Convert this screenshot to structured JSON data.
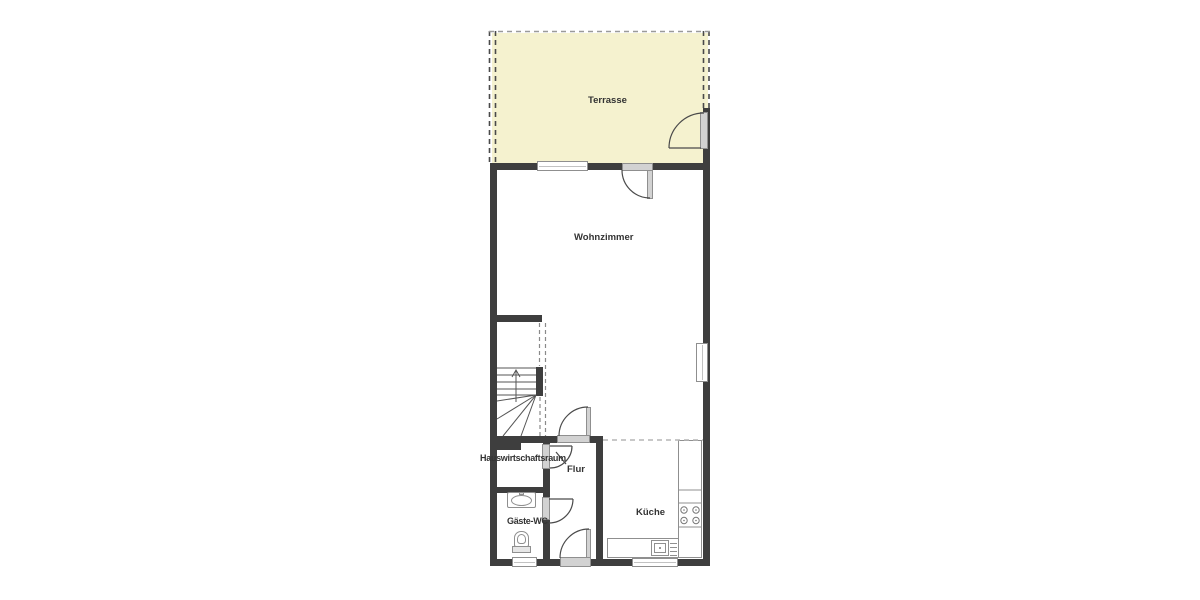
{
  "rooms": {
    "terrasse": {
      "label": "Terrasse"
    },
    "wohnzimmer": {
      "label": "Wohnzimmer"
    },
    "hauswirtschaftsraum": {
      "label": "Hauswirtschaftsraum"
    },
    "flur": {
      "label": "Flur"
    },
    "gaeste_wc": {
      "label": "Gäste-WC"
    },
    "kueche": {
      "label": "Küche"
    }
  },
  "fixtures": {
    "staircase": "winder-stairs-up-icon",
    "wc_sink": "washbasin-icon",
    "wc_toilet": "toilet-icon",
    "kitchen_counter": "l-shaped-counter-icon",
    "kitchen_sink": "kitchen-sink-with-drainer-icon",
    "cooktop": "cooktop-4-burners-icon",
    "doors": "swing-door-arc-icon",
    "windows": "window-icon"
  },
  "colors": {
    "background": "#ffffff",
    "wall": "#3e3e3e",
    "terrace_fill": "#f5f2cf",
    "opening_fill": "#d2d2d2",
    "opening_border": "#8f8f8f",
    "fixture_border": "#8f8f8f",
    "label_text": "#333333",
    "dashed_line": "#4a4a4a",
    "light_dashed_line": "#b5b5b5"
  }
}
